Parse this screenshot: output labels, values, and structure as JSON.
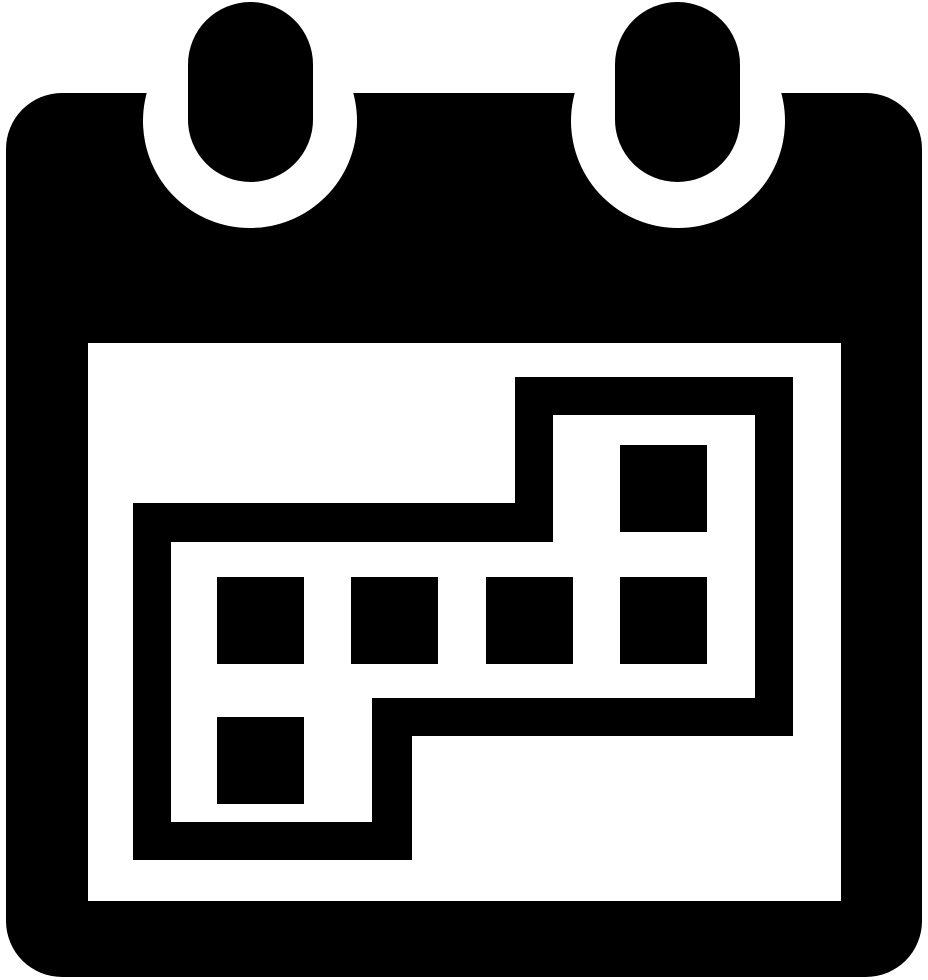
{
  "icon": {
    "name": "calendar-with-marked-dates",
    "description": "black calendar glyph with two binder rings and an S-shaped outlined block of marked date cells",
    "foreground_color": "#000000",
    "background_color": "#ffffff",
    "grid": {
      "rows": 3,
      "cols": 4
    },
    "marked_cells": [
      {
        "row": 0,
        "col": 3
      },
      {
        "row": 1,
        "col": 0
      },
      {
        "row": 1,
        "col": 1
      },
      {
        "row": 1,
        "col": 2
      },
      {
        "row": 1,
        "col": 3
      },
      {
        "row": 2,
        "col": 0
      }
    ]
  }
}
